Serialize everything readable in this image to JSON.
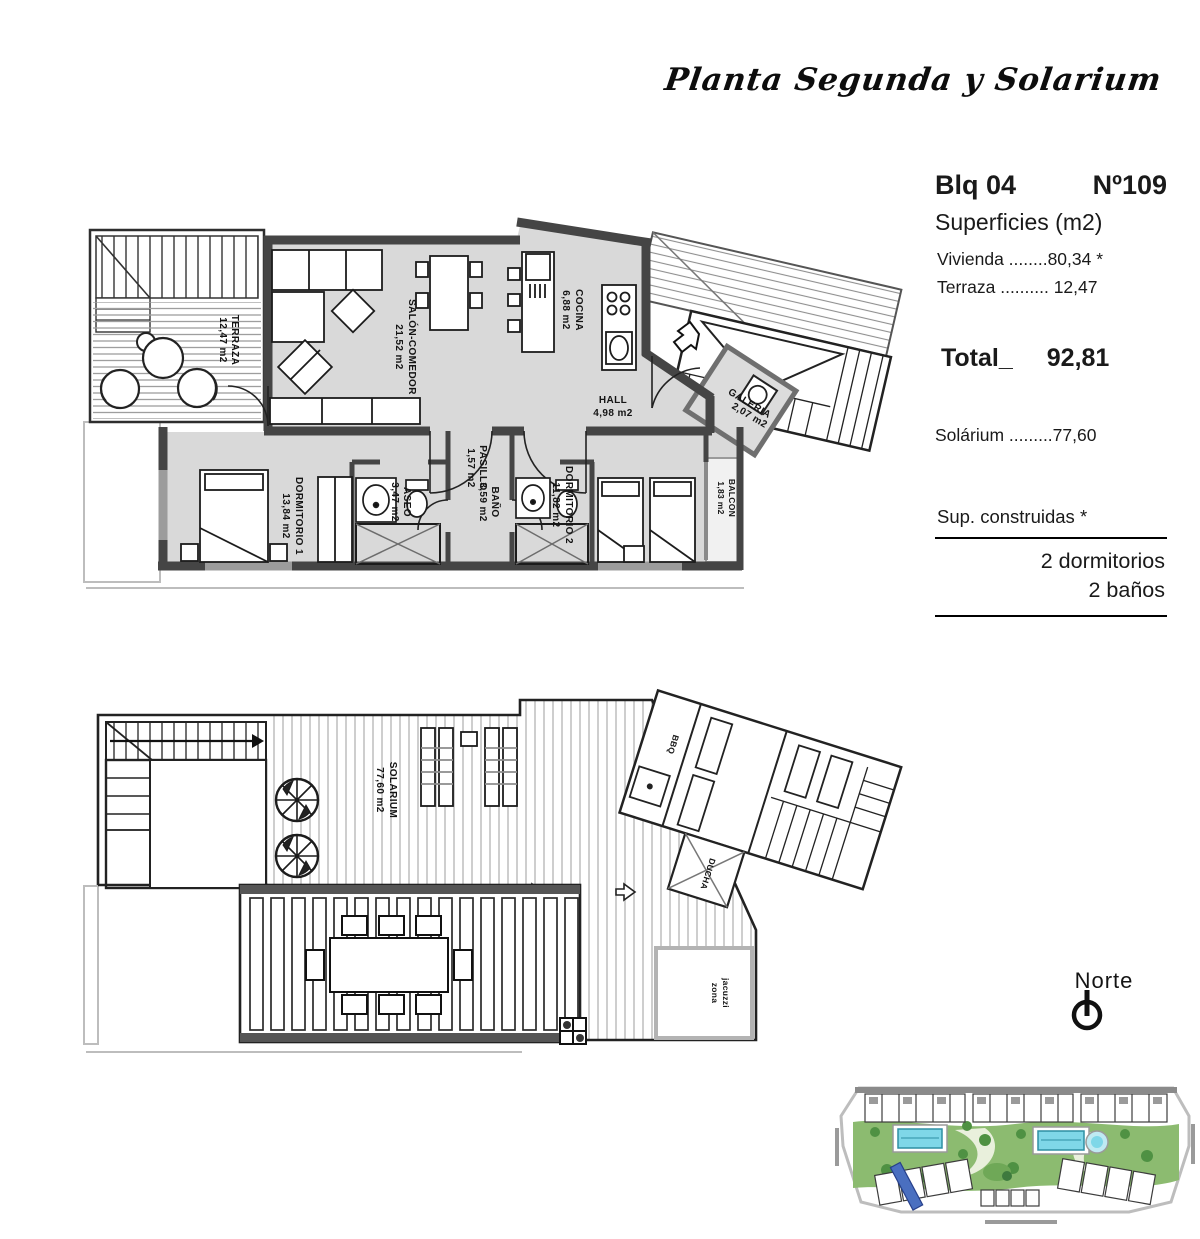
{
  "header": {
    "title": "Planta Segunda y Solarium"
  },
  "info_panel": {
    "block": "Blq 04",
    "unit": "Nº109",
    "surfaces_heading": "Superficies (m2)",
    "vivienda_line": "Vivienda ........80,34 *",
    "terraza_line": "Terraza .......... 12,47",
    "total_label": "Total_",
    "total_value": "92,81",
    "solarium_line": "Solárium .........77,60",
    "sup_construidas": "Sup. construidas *",
    "dormitorios": "2 dormitorios",
    "banos": "2 baños"
  },
  "upper_plan": {
    "terraza": {
      "name": "TERRAZA",
      "area": "12,47 m2"
    },
    "salon": {
      "name": "SALÓN-COMEDOR",
      "area": "21,52 m2"
    },
    "cocina": {
      "name": "COCINA",
      "area": "6,88 m2"
    },
    "hall": {
      "name": "HALL",
      "area": "4,98 m2"
    },
    "galeria": {
      "name": "GALERIA",
      "area": "2,07 m2"
    },
    "pasillo": {
      "name": "PASILLO",
      "area": "1,57 m2"
    },
    "aseo": {
      "name": "ASEO",
      "area": "3,47 m2"
    },
    "bano": {
      "name": "BAÑO",
      "area": "3,59 m2"
    },
    "dormitorio1": {
      "name": "DORMITORIO 1",
      "area": "13,84 m2"
    },
    "dormitorio2": {
      "name": "DORMITORIO 2",
      "area": "11,82 m2"
    },
    "balcon": {
      "name": "BALCON",
      "area": "1,83 m2"
    }
  },
  "lower_plan": {
    "solarium": {
      "name": "SOLARIUM",
      "area": "77,60 m2"
    },
    "bbq_label": "BBQ",
    "ducha_label": "DUCHA",
    "jacuzzi_line1": "zona",
    "jacuzzi_line2": "jacuzzi"
  },
  "north": {
    "label": "Norte"
  }
}
